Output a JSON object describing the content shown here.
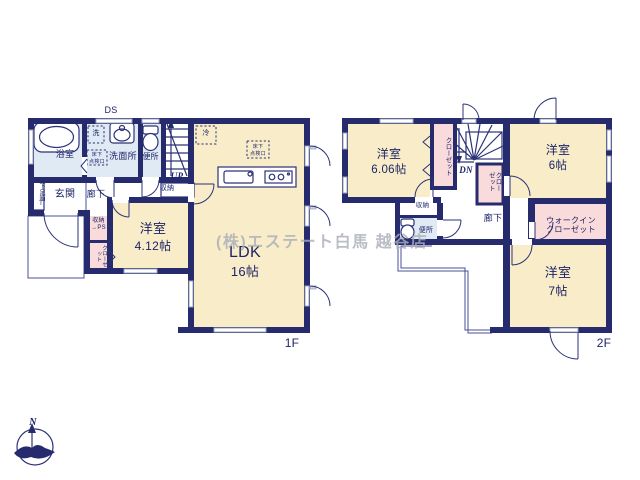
{
  "watermark": "(株)エステート白馬 越谷店",
  "compass": {
    "north": "N"
  },
  "floor1": {
    "tag": "1F",
    "ds": "DS",
    "bath": "浴室",
    "washer": "洗",
    "laundry": "洗面所",
    "underfloor_hatch": "床下\n点検口",
    "toilet": "便所",
    "up": "UP",
    "stair_storage": "収納",
    "entrance": "玄関",
    "hallway": "廊下",
    "shoe_box": "下足箱T",
    "storage_ps": "収納\n→PS",
    "closet": "クローゼット",
    "bedroom": "洋室",
    "bedroom_size": "4.12帖",
    "ldk": "LDK",
    "ldk_size": "16帖",
    "fridge": "冷"
  },
  "floor2": {
    "tag": "2F",
    "bedroom1": "洋室",
    "bedroom1_size": "6.06帖",
    "closet_left": "クローゼット",
    "dn": "DN",
    "closet_mid": "クローゼット",
    "bedroom2": "洋室",
    "bedroom2_size": "6帖",
    "storage": "収納",
    "toilet": "便所",
    "hallway": "廊下",
    "wic": "ウォークイン\nクローゼット",
    "bedroom3": "洋室",
    "bedroom3_size": "7帖"
  },
  "colors": {
    "wall": "#262b6e",
    "cream": "#f9edc9",
    "pink": "#f8dbda",
    "wet": "#dfeaf4",
    "line": "#2c3378",
    "thinline": "#4a5198",
    "wingray": "#9aa3bb",
    "ink": "#1d2368",
    "watermark": "#a9adb8"
  }
}
